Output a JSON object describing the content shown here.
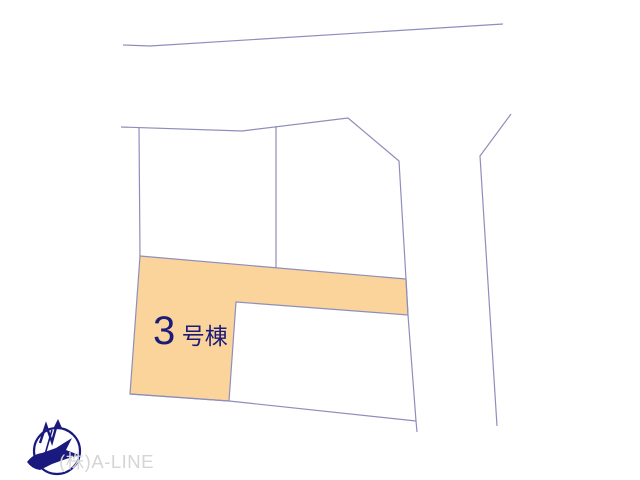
{
  "page": {
    "background": "#ffffff"
  },
  "plot_map": {
    "line_color": "#8E8EBC",
    "shapes": {
      "road_top": "123,45 150,46 503,24",
      "road_right": "511,114 480,156 497,426",
      "boundary_top": "121,127 242,131 348,118",
      "boundary_right": "348,118 399,161 406,279 408,315 416,421 417,432",
      "boundary_left": "139,128 140,256",
      "boundary_bottom": "130,394 229,401 416,421",
      "divider_vertical": "276,126 276,268",
      "plot3_outline": "140,256 406,279 408,315 236,302 229,401 130,394"
    },
    "plot3": {
      "fill_color": "#FBD49C",
      "label_number": "3",
      "label_suffix": "号棟",
      "label_color": "#1C1C78"
    }
  },
  "footer": {
    "company_name": "(株)A-LINE",
    "company_color": "#D5D5D5",
    "compass_icon": "north-compass-icon",
    "compass_color": "#1A1A7E"
  }
}
